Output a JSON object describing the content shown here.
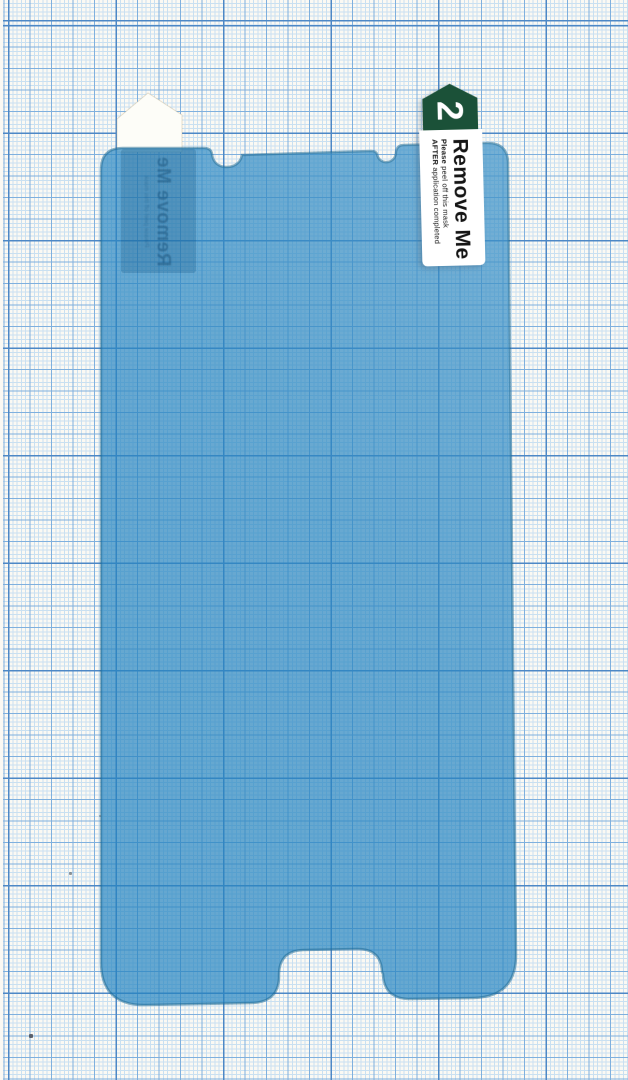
{
  "colors": {
    "paper-bg": "#fbf9f3",
    "grid-fine": "#c9e0f1",
    "grid-med": "#7fb0de",
    "grid-bold": "#4d88c6",
    "film-fill": "#2585c0",
    "film-edge": "#196690",
    "film-shade": "#0a4a78",
    "tab-green": "#1b5138",
    "tab-bg": "#ffffff",
    "tab-ink": "#151515",
    "ghost-ink": "#10466e"
  },
  "tab_step2": {
    "number": "2",
    "title": "Remove Me",
    "note1_lead": "Please",
    "note1_rest": "peel off this mask",
    "note2_lead": "AFTER",
    "note2_rest": "application completed"
  },
  "tab_step1_ghost": {
    "title": "Remove Me",
    "note": "Please peel off this mask"
  }
}
